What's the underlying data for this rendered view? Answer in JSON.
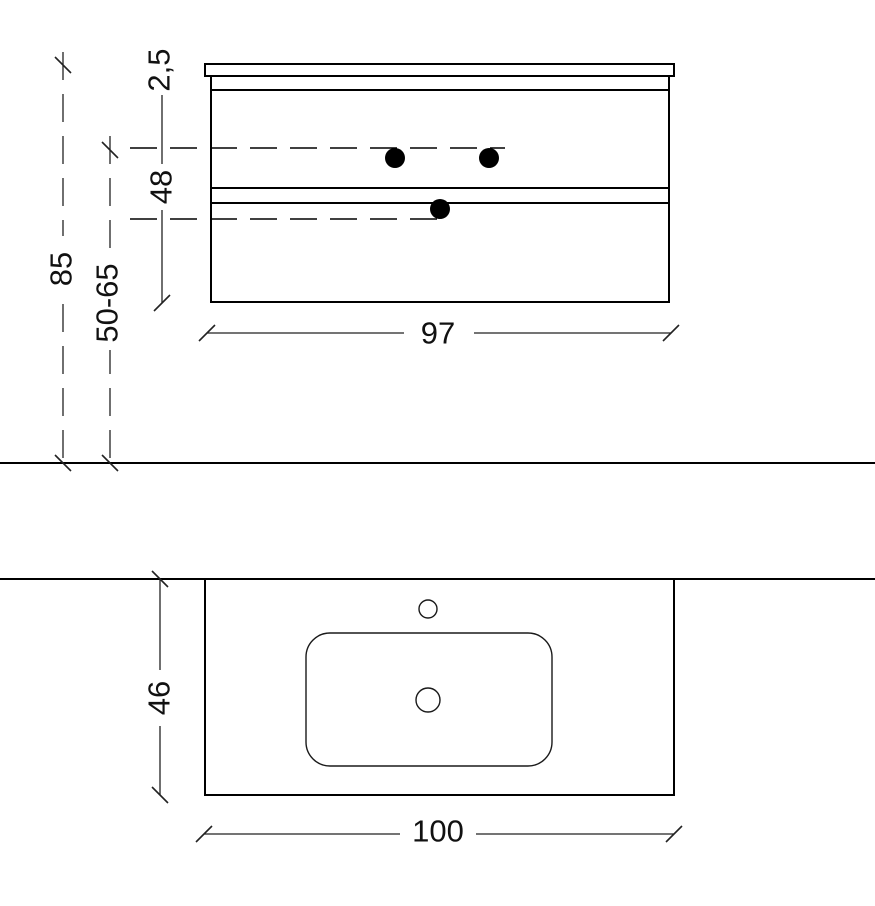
{
  "front_view": {
    "dim_total_height": "85",
    "dim_mount_range": "50-65",
    "dim_top_thickness": "2,5",
    "dim_body_height": "48",
    "dim_width": "97"
  },
  "plan_view": {
    "dim_depth": "46",
    "dim_width": "100"
  }
}
